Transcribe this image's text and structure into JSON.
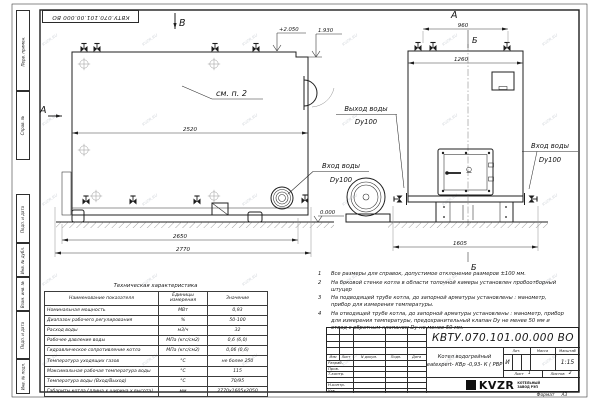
{
  "meta": {
    "watermark": "KVZR.RU"
  },
  "stamp_top": "КВТУ.070.101.00.000  ВО",
  "margin_labels": {
    "perv": "Перв. примен.",
    "sprav": "Справ. №",
    "podp1": "Подп. и дата",
    "inv_dubl": "Инв. № дубл.",
    "vzam": "Взам. инв. №",
    "podp2": "Подп. и дата",
    "inv_podl": "Инв. № подл."
  },
  "views": {
    "side": {
      "view_arrow": "В",
      "section_label": "А",
      "callout": "см. п. 2",
      "dim_inner": "2520",
      "dim_2650": "2650",
      "dim_2770": "2770",
      "elev_top": "+2.050",
      "elev_step": "1.930",
      "elev_zero": "0.000"
    },
    "front": {
      "title": "А",
      "section_top": "Б",
      "section_bottom": "Б",
      "dim_960": "960",
      "dim_1260": "1260",
      "dim_1605": "1605"
    },
    "pipe_labels": {
      "outlet_1": "Выход воды",
      "outlet_2": "Dy100",
      "inlet_center_1": "Вход воды",
      "inlet_center_2": "Dy100",
      "inlet_right_1": "Вход воды",
      "inlet_right_2": "Dy100"
    }
  },
  "notes": {
    "items": [
      {
        "num": "1",
        "text": "Все размеры для справок, допустимое отклонение размеров ±100 мм."
      },
      {
        "num": "2",
        "text": "На боковой стенке котла в области топочной камеры установлен пробоотборный штуцер"
      },
      {
        "num": "3",
        "text": "На  подводящей трубе котла, до запорной арматуры установлены : манометр, прибор для измерения температуры."
      },
      {
        "num": "4",
        "text": "На отводящей трубе котла, до запорной арматуры установлены : манометр, прибор для измерения температуры, предохранительный клапан Dу не менее 50 мм и отвод с обратным клапаном Dу не менее 50 мм."
      }
    ]
  },
  "spec_table": {
    "title": "Техническая характеристика",
    "headers": [
      "Наименование показателя",
      "Единицы измерения",
      "Значение"
    ],
    "rows": [
      [
        "Номинальная мощность",
        "МВт",
        "0,93"
      ],
      [
        "Диапазон рабочего регулирования",
        "%",
        "50-100"
      ],
      [
        "Расход воды",
        "м3/ч",
        "32"
      ],
      [
        "Рабочее давление воды",
        "МПа (кгс/см2)",
        "0,6 (6,0)"
      ],
      [
        "Гидравлическое сопротивление котла",
        "МПа (кгс/см2)",
        "0,06 (0,6)"
      ],
      [
        "Температура уходящих газов",
        "°С",
        "не более 250"
      ],
      [
        "Максимальная рабочая температура воды",
        "°С",
        "115"
      ],
      [
        "Температура воды (Вход/Выход)",
        "°С",
        "70/95"
      ],
      [
        "Габариты котла (длина х ширина х высота)",
        "мм",
        "2770х1605х2050"
      ]
    ]
  },
  "title_block": {
    "doc_number": "КВТУ.070.101.00.000  ВО",
    "product_name_line1": "Котел водогрейный",
    "product_name_line2": "Heatexpert- КВр -0,93- К ( РВР )",
    "header_cells": {
      "izm": "Изм",
      "list": "Лист",
      "doc": "N докум.",
      "podp": "Подп.",
      "data": "Дата"
    },
    "roles": [
      "Разраб.",
      "Пров.",
      "Т.контр.",
      "",
      "Н.контр.",
      "Утв."
    ],
    "lit_header": "Лит.",
    "mass_header": "Масса",
    "scale_header": "Масштаб",
    "lit_value": "И",
    "scale_value": "1:15",
    "sheet_label": "Лист",
    "sheet_value": "1",
    "sheets_label": "Листов",
    "sheets_value": "2",
    "logo_text": "KVZR",
    "org_line1": "КОТЕЛЬНЫЙ",
    "org_line2": "ЗАВОД РЭП",
    "format_label": "Формат",
    "format_value": "А3"
  }
}
